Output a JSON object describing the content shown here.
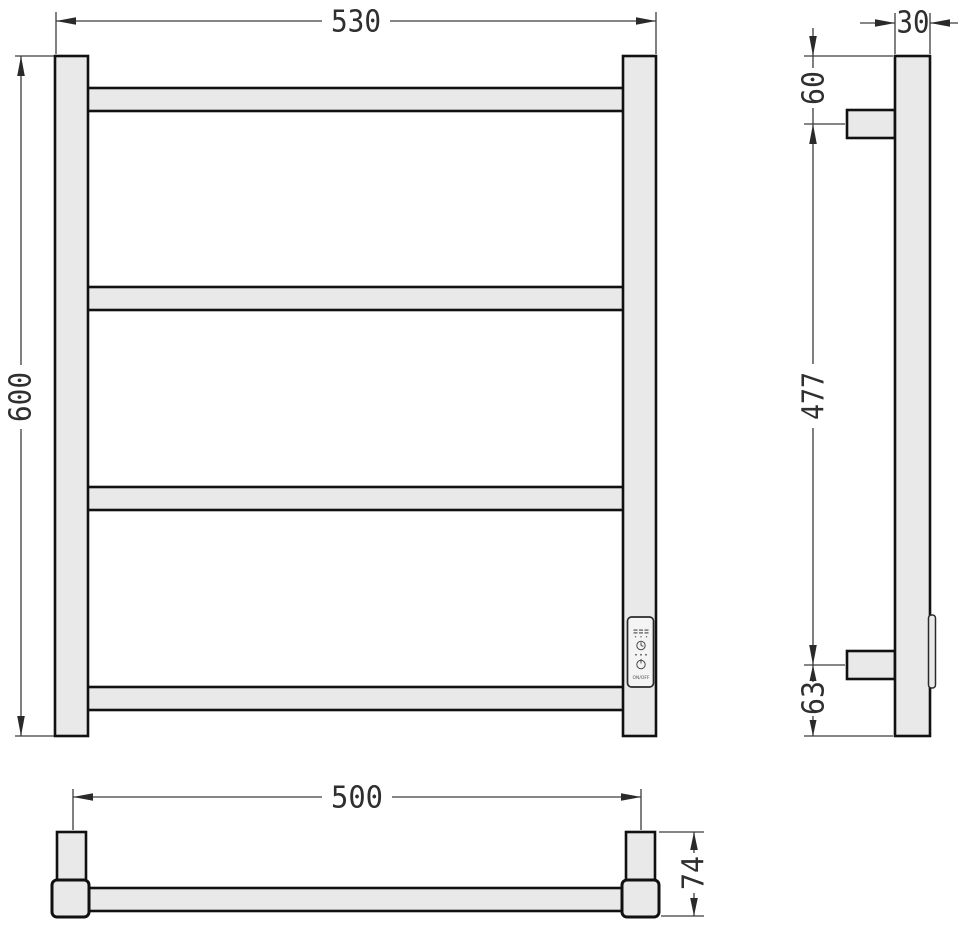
{
  "drawing": {
    "colors": {
      "background": "#ffffff",
      "object_fill": "#e9e9e9",
      "object_outline": "#111111",
      "dimension_lines": "#3d3d3d",
      "dimension_text": "#2f2f2f",
      "panel_fill": "#f4f4f4"
    },
    "front_view": {
      "width_dim": "530",
      "height_dim": "600",
      "rung_count": 4,
      "panel": {
        "label": "ON/OFF",
        "icons": [
          "heat-level-marks-icon",
          "timer-clock-icon",
          "indicator-dots-icon",
          "power-icon"
        ]
      }
    },
    "side_view": {
      "depth_dim": "30",
      "top_offset_dim": "60",
      "bracket_span_dim": "477",
      "bottom_offset_dim": "63"
    },
    "bottom_view": {
      "mount_span_dim": "500",
      "depth_dim": "74"
    }
  }
}
